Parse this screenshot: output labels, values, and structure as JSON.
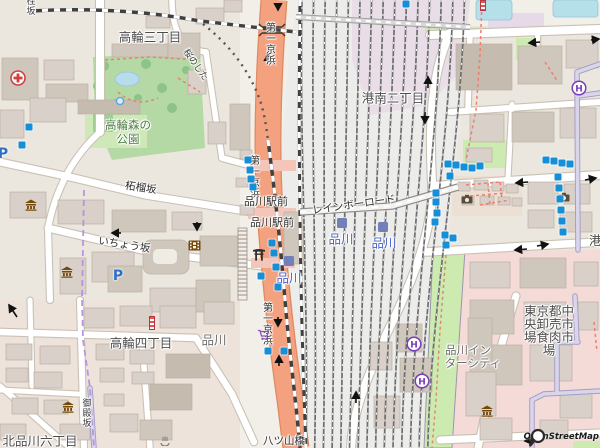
{
  "map": {
    "attribution": "OpenStreetMap",
    "theme": {
      "background": "#f2efe9",
      "trunk_road": "#f4a17f",
      "park_green": "#b4d9a5",
      "grass_green": "#cdebb0",
      "water_blue": "#b5e0ea",
      "building": "#d9d0c9",
      "retail_pink": "#f4dbd8",
      "railway_lavender": "#e9dce8",
      "bus_stop_blue": "#1590d8",
      "station_indigo": "#7280ba",
      "station_label_blue": "#4a5fc4",
      "footway_red": "#ea8070",
      "boundary_purple": "#b48be0",
      "hotel_purple": "#7a3db8",
      "museum_brown": "#734a08",
      "parking_blue": "#2e6fc4",
      "hospital_red": "#d04040"
    },
    "labels": {
      "district_takanawa3": "高輪三丁目",
      "district_konan2": "港南二丁目",
      "district_takanawa4": "高輪四丁目",
      "district_kitashinagawa6": "北品川六丁目",
      "district_shinagawa": "品川",
      "district_minato_partial": "港",
      "park_l1": "高輪森の",
      "park_l2": "公園",
      "road_zakurozaka": "柘榴坂",
      "road_ichozaka": "いちょう坂",
      "road_rainbow_road": "レインボーロード",
      "road_daiichi_keihin": "第一京浜",
      "road_yatsuyamabashi": "八ツ山橋",
      "road_sakuranoshita": "桜のした",
      "road_gotenzaka": "御殿坂",
      "road_katsurazaka": "桂坂",
      "crossing_shinagawa_ekimae": "品川駅前",
      "station_shinagawa": "品川",
      "intercity_l1": "品川イン",
      "intercity_l2": "ターシティ",
      "market_l1": "東京都中",
      "market_l2": "央卸売市",
      "market_l3": "場食肉市",
      "market_l4": "場",
      "hotel_letter": "H",
      "parking_letter": "P"
    },
    "icons": {
      "hospital": "red-cross-circle",
      "parking": "blue-P",
      "museum": "classical-building",
      "cinema": "film-strip",
      "shrine": "torii-gate",
      "hotel": "purple-H-circle",
      "supermarket": "purple-cart",
      "photo_spot": "camera",
      "bus_stop": "blue-square",
      "railway_station": "indigo-square",
      "fountain": "blue-circle",
      "roadworks": "red-white-striped-pole",
      "onsen": "gray-spring",
      "osm_logo": "magnifier"
    }
  }
}
